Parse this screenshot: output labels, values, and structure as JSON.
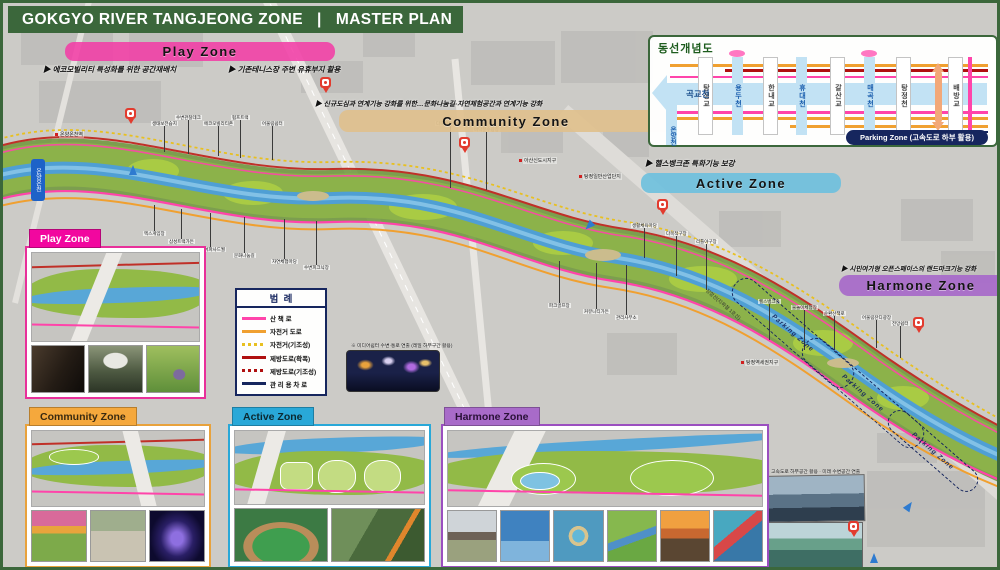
{
  "title": "GOKGYO RIVER TANGJEONG ZONE   |   MASTER PLAN",
  "zones": {
    "play": {
      "label": "Play Zone",
      "color": "#f23ea6"
    },
    "community": {
      "label": "Community Zone",
      "color": "#dfc08d"
    },
    "active": {
      "label": "Active Zone",
      "color": "#6fc0dd"
    },
    "harmone": {
      "label": "Harmone Zone",
      "color": "#a86bc9"
    }
  },
  "annotations": {
    "play_1": "▶ 에코모빌리티 특성화를 위한 공간재배치",
    "play_2": "▶ 기존테니스장 주변 유휴부지 활용",
    "community_1": "▶ 신규도심과 연계기능 강화를 위한…문화나눔길·자연체험공간과 연계기능 강화",
    "active_1": "▶ 헬스뱅크존 특화기능 보강",
    "harmone_1": "▶ 시민여가형 오픈스페이스의 랜드마크기능 강화"
  },
  "diagram": {
    "title": "동선개념도",
    "river_label": "곡교천",
    "side_stream": "온양천",
    "columns": [
      {
        "label": "탕정교",
        "type": "bridge"
      },
      {
        "label": "용두천",
        "type": "stream"
      },
      {
        "label": "한내교",
        "type": "bridge"
      },
      {
        "label": "휴대천",
        "type": "stream"
      },
      {
        "label": "갈산교",
        "type": "bridge"
      },
      {
        "label": "매곡천",
        "type": "stream"
      },
      {
        "label": "탕정천",
        "type": "bridge"
      },
      {
        "label": "배방교",
        "type": "bridge"
      }
    ],
    "parking_label": "Parking Zone (고속도로 하부 활용)"
  },
  "legend": {
    "title": "범  례",
    "items": [
      {
        "label": "산  책  로",
        "line": "solid",
        "color": "#ff44aa"
      },
      {
        "label": "자전거 도로",
        "line": "solid",
        "color": "#f0a030"
      },
      {
        "label": "자전거(기조성)",
        "line": "dotted",
        "color": "#e8c020"
      },
      {
        "label": "제방도로(확폭)",
        "line": "solid",
        "color": "#b01010"
      },
      {
        "label": "제방도로(기조성)",
        "line": "dotted",
        "color": "#b01010"
      },
      {
        "label": "관 리 용 차 로",
        "line": "solid",
        "color": "#16265e"
      }
    ]
  },
  "map": {
    "road_sign": "온양온천",
    "rail_label": "장항선(지하철 1호선)",
    "parking_outline_label": "Parking Zone",
    "captions": {
      "media_wall": "※ 미디어쉼터 수변·통로 연출 (레일 하부구간 활용)",
      "future_space": "※ 고속도로 하부공간 활용 · 미래 수변공간 연출"
    },
    "place_labels": [
      "아산신도시지구",
      "탕정일반산업단지",
      "탕정역세권지구",
      "온양온천역"
    ],
    "callouts": [
      "생태보전습지",
      "수변관찰데크",
      "에코모빌리티존",
      "펌프트랙",
      "어울림쉼터",
      "엑스게임장",
      "삼성트랙가든",
      "미디어파사드월",
      "문화나눔길",
      "자연체험마당",
      "수변피크닉장",
      "다목적잔디마당",
      "바닥분수광장",
      "파크골프장",
      "커뮤니티가든",
      "관리사무소",
      "생활체육마당",
      "다목적구장",
      "리틀야구장",
      "헬스뱅크존",
      "물놀이체험장",
      "순환산책로",
      "어울림잔디광장",
      "전망쉼터"
    ]
  },
  "insets": {
    "play": {
      "label": "Play Zone",
      "photos": [
        "warehouse-bike-park",
        "outdoor-cinema",
        "pump-track"
      ]
    },
    "community": {
      "label": "Community Zone",
      "photos": [
        "flower-garden",
        "picnic-plaza",
        "light-tunnel"
      ]
    },
    "active": {
      "label": "Active Zone",
      "photos": [
        "baseball-field",
        "outdoor-fitness"
      ]
    },
    "harmone": {
      "label": "Harmone Zone",
      "photos": [
        "shade-canopy",
        "wave-pool",
        "water-playground",
        "play-hill",
        "sunset-lawn",
        "adventure-playground"
      ]
    }
  }
}
